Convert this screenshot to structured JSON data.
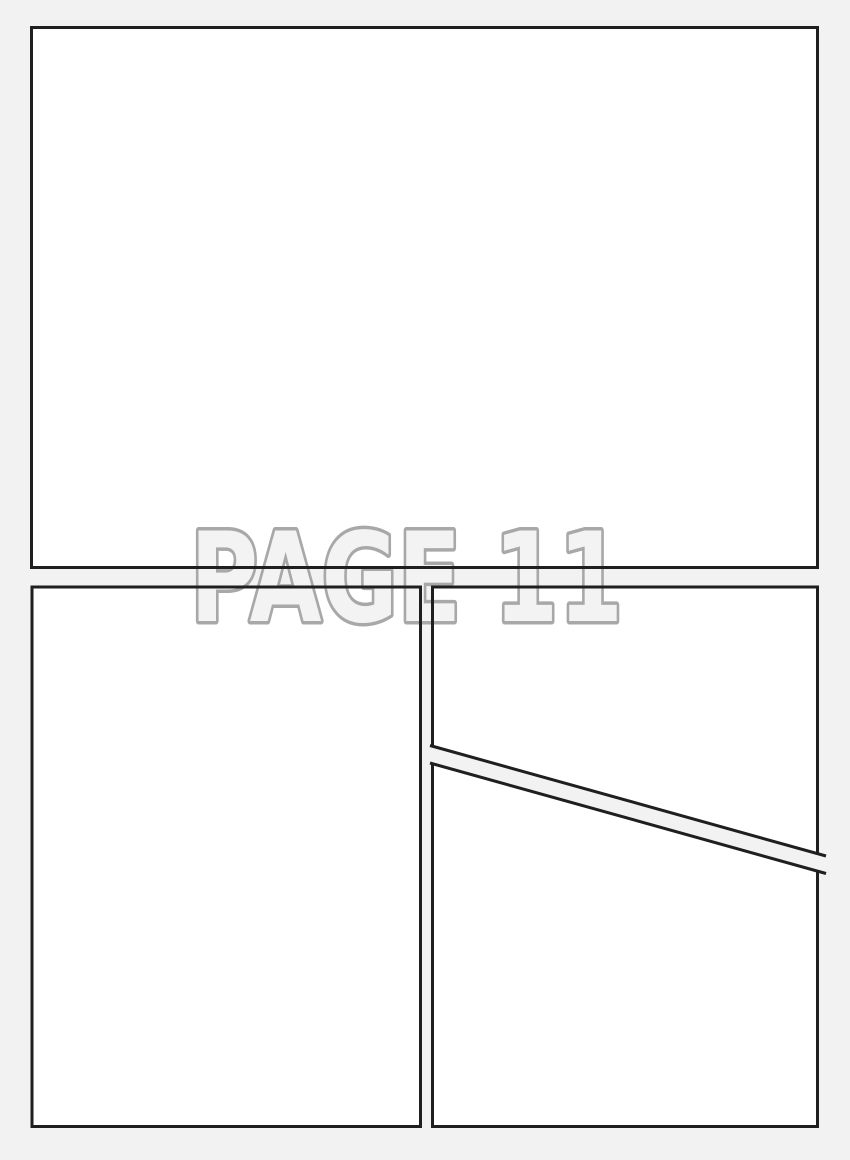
{
  "page": {
    "label": "PAGE 11",
    "colors": {
      "background": "#f2f2f2",
      "panel_fill": "#ffffff",
      "panel_border": "#1f1f1f",
      "label_fill": "#f3f3f3",
      "label_outline": "#a8a8a8"
    },
    "panels": [
      {
        "name": "top",
        "shape": "rectangle"
      },
      {
        "name": "bottom-left",
        "shape": "rectangle"
      },
      {
        "name": "bottom-right",
        "shape": "rectangle with diagonal gutter"
      }
    ]
  }
}
